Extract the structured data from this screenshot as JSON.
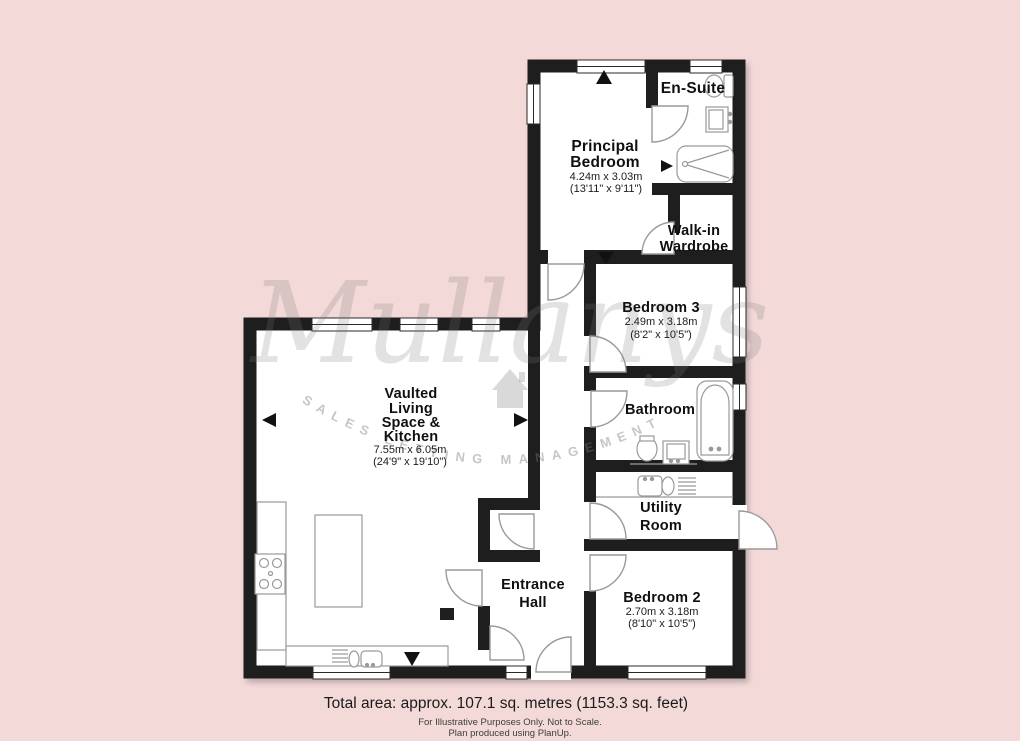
{
  "watermark": {
    "brand": "Mullanys",
    "tagline": "SALES LETTING MANAGEMENT"
  },
  "rooms": {
    "en_suite": {
      "name": "En-Suite"
    },
    "principal_bedroom": {
      "line1": "Principal",
      "line2": "Bedroom",
      "metric": "4.24m x 3.03m",
      "imperial": "(13'11\" x 9'11\")"
    },
    "walk_in_wardrobe": {
      "line1": "Walk-in",
      "line2": "Wardrobe"
    },
    "bedroom_3": {
      "name": "Bedroom 3",
      "metric": "2.49m x 3.18m",
      "imperial": "(8'2\" x 10'5\")"
    },
    "bathroom": {
      "name": "Bathroom"
    },
    "utility_room": {
      "line1": "Utility",
      "line2": "Room"
    },
    "living_kitchen": {
      "line1": "Vaulted",
      "line2": "Living",
      "line3": "Space &",
      "line4": "Kitchen",
      "metric": "7.55m x 6.05m",
      "imperial": "(24'9\" x 19'10\")"
    },
    "entrance_hall": {
      "line1": "Entrance",
      "line2": "Hall"
    },
    "bedroom_2": {
      "name": "Bedroom 2",
      "metric": "2.70m x 3.18m",
      "imperial": "(8'10\" x 10'5\")"
    }
  },
  "footer": {
    "total_area": "Total area: approx. 107.1 sq. metres (1153.3 sq. feet)",
    "disclaimer": "For Illustrative Purposes Only. Not to Scale.",
    "credit": "Plan produced using PlanUp."
  },
  "colors": {
    "background": "#f4d9d9",
    "wall": "#1e1e1e",
    "watermark_gray": "#9a9a9a"
  }
}
